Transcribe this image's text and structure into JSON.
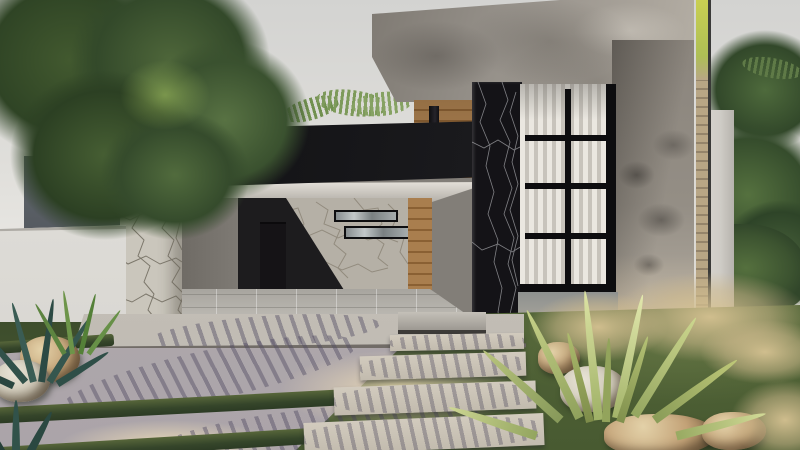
{
  "scene": {
    "description": "Photorealistic exterior render of a modern single-story house at dusk with carport, stone cladding, wood pivot door, black marble column and gridded window",
    "house_number": "475",
    "palette": {
      "sky": "#e3e2de",
      "fascia_black": "#17171a",
      "number_glow": "#ffffff",
      "concrete_grey": "#96918a",
      "stone_cladding": "#cac6bc",
      "marble_black": "#141317",
      "wood_brown": "#a97e4e",
      "window_frame": "#0d0d0f",
      "blind_white": "#eae7e0",
      "lawn_green": "#4c5d34",
      "paver_grey": "#b3adae",
      "rock_tan": "#c3a277"
    }
  }
}
